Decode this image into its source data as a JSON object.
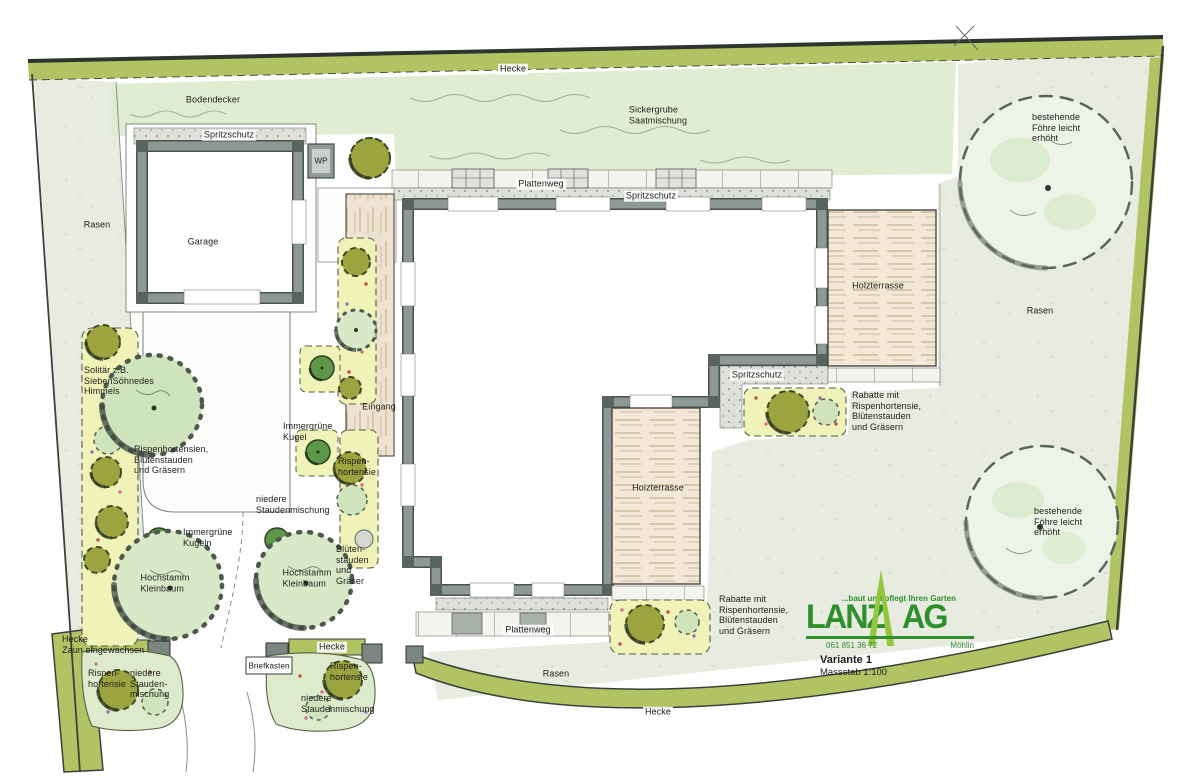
{
  "plan": {
    "colors": {
      "hedge": "#b2c364",
      "lawn": "#e8ebdf",
      "ground_green": "#e0edd3",
      "bed_yellow": "#f0f3b8",
      "bed_green": "#ddebcc",
      "wall_gray": "#8d9897",
      "wood": "#f2e8d5",
      "logo_green": "#2e8f2d",
      "logo_light_green": "#94c73e"
    }
  },
  "logo": {
    "tagline": "...baut und pflegt Ihren Garten",
    "word_left": "LANZ",
    "word_right": "AG",
    "phone": "061 851 36 72",
    "city": "Möhlin"
  },
  "title_block": {
    "variant": "Variante 1",
    "scale": "Massstab 1:100"
  },
  "labels": [
    {
      "id": "hecke-top",
      "text": "Hecke",
      "x": 513,
      "y": 69,
      "chip": true
    },
    {
      "id": "bodendecker",
      "text": "Bodendecker",
      "x": 213,
      "y": 100
    },
    {
      "id": "spritzschutz-garage",
      "text": "Spritzschutz",
      "x": 229,
      "y": 135,
      "chip": true
    },
    {
      "id": "wp",
      "text": "WP",
      "x": 321,
      "y": 161,
      "size": 8
    },
    {
      "id": "garage",
      "text": "Garage",
      "x": 203,
      "y": 242
    },
    {
      "id": "rasen-left",
      "text": "Rasen",
      "x": 97,
      "y": 225
    },
    {
      "id": "sickergrube",
      "text": "Sickergrube\nSaatmischung",
      "x": 658,
      "y": 115
    },
    {
      "id": "plattenweg-top",
      "text": "Plattenweg",
      "x": 541,
      "y": 184,
      "chip": true
    },
    {
      "id": "spritzschutz-top",
      "text": "Spritzschutz",
      "x": 651,
      "y": 196,
      "chip": true
    },
    {
      "id": "holzterrasse-1",
      "text": "Holzterrasse",
      "x": 878,
      "y": 286
    },
    {
      "id": "foehre-top",
      "text": "bestehende\nFöhre leicht\nerhöht",
      "x": 1032,
      "y": 112,
      "align": "left"
    },
    {
      "id": "rasen-right",
      "text": "Rasen",
      "x": 1040,
      "y": 311
    },
    {
      "id": "spritzschutz-mid",
      "text": "Spritzschutz",
      "x": 757,
      "y": 375,
      "chip": true
    },
    {
      "id": "rabatte-right",
      "text": "Rabatte mit\nRispenhortensie,\nBlütenstauden\nund Gräsern",
      "x": 852,
      "y": 390,
      "align": "left"
    },
    {
      "id": "eingang",
      "text": "Eingang",
      "x": 379,
      "y": 407
    },
    {
      "id": "immergruene-kugel",
      "text": "Immergrüne\nKugel",
      "x": 283,
      "y": 421,
      "align": "left"
    },
    {
      "id": "rispenhortensie-mid",
      "text": "Rispen-\nhortensie",
      "x": 338,
      "y": 456,
      "align": "left"
    },
    {
      "id": "solitaer",
      "text": "Solitär z.B.\nSiebenSöhnedes\nHimmels",
      "x": 84,
      "y": 365,
      "align": "left"
    },
    {
      "id": "rispenhortensien-left",
      "text": "Rispenhortensien,\nBlütenstauden\nund Gräsern",
      "x": 134,
      "y": 444,
      "align": "left"
    },
    {
      "id": "staudenmischung-mid",
      "text": "niedere\nStaudenmischung",
      "x": 256,
      "y": 494,
      "align": "left"
    },
    {
      "id": "immergruene-kugeln",
      "text": "Immergrüne\nKugeln",
      "x": 183,
      "y": 527,
      "align": "left"
    },
    {
      "id": "hochstamm-1",
      "text": "Hochstamm\nKleinbaum",
      "x": 165,
      "y": 583
    },
    {
      "id": "hochstamm-2",
      "text": "Hochstamm\nKleinbaum",
      "x": 307,
      "y": 578
    },
    {
      "id": "bluetenstauden",
      "text": "Blüten-\nstauden\nund\nGräser",
      "x": 336,
      "y": 544,
      "align": "left"
    },
    {
      "id": "hecke-zaun",
      "text": "Hecke\nZaun eingewachsen",
      "x": 62,
      "y": 634,
      "align": "left"
    },
    {
      "id": "rispenhortensie-bl",
      "text": "Rispen-\nhortensie",
      "x": 88,
      "y": 668,
      "align": "left"
    },
    {
      "id": "stauden-bl",
      "text": "niedere\nStauden-\nmischung",
      "x": 130,
      "y": 668,
      "align": "left"
    },
    {
      "id": "briefkasten",
      "text": "Briefkasten",
      "x": 269,
      "y": 666,
      "size": 8
    },
    {
      "id": "hecke-gate",
      "text": "Hecke",
      "x": 332,
      "y": 647,
      "chip": true
    },
    {
      "id": "rispenhortensie-br",
      "text": "Rispen-\nhortensie",
      "x": 330,
      "y": 661,
      "align": "left"
    },
    {
      "id": "stauden-br",
      "text": "niedere\nStaudenmischung",
      "x": 301,
      "y": 693,
      "align": "left"
    },
    {
      "id": "holzterrasse-2",
      "text": "Holzterrasse",
      "x": 658,
      "y": 488
    },
    {
      "id": "rabatte-bottom",
      "text": "Rabatte mit\nRispenhortensie,\nBlütenstauden\nund Gräsern",
      "x": 719,
      "y": 594,
      "align": "left"
    },
    {
      "id": "plattenweg-bottom",
      "text": "Plattenweg",
      "x": 528,
      "y": 630,
      "chip": true
    },
    {
      "id": "rasen-bottom",
      "text": "Rasen",
      "x": 556,
      "y": 674
    },
    {
      "id": "hecke-bottom",
      "text": "Hecke",
      "x": 658,
      "y": 712,
      "chip": true
    },
    {
      "id": "foehre-bottom",
      "text": "bestehende\nFöhre leicht\nerhöht",
      "x": 1034,
      "y": 506,
      "align": "left"
    }
  ]
}
